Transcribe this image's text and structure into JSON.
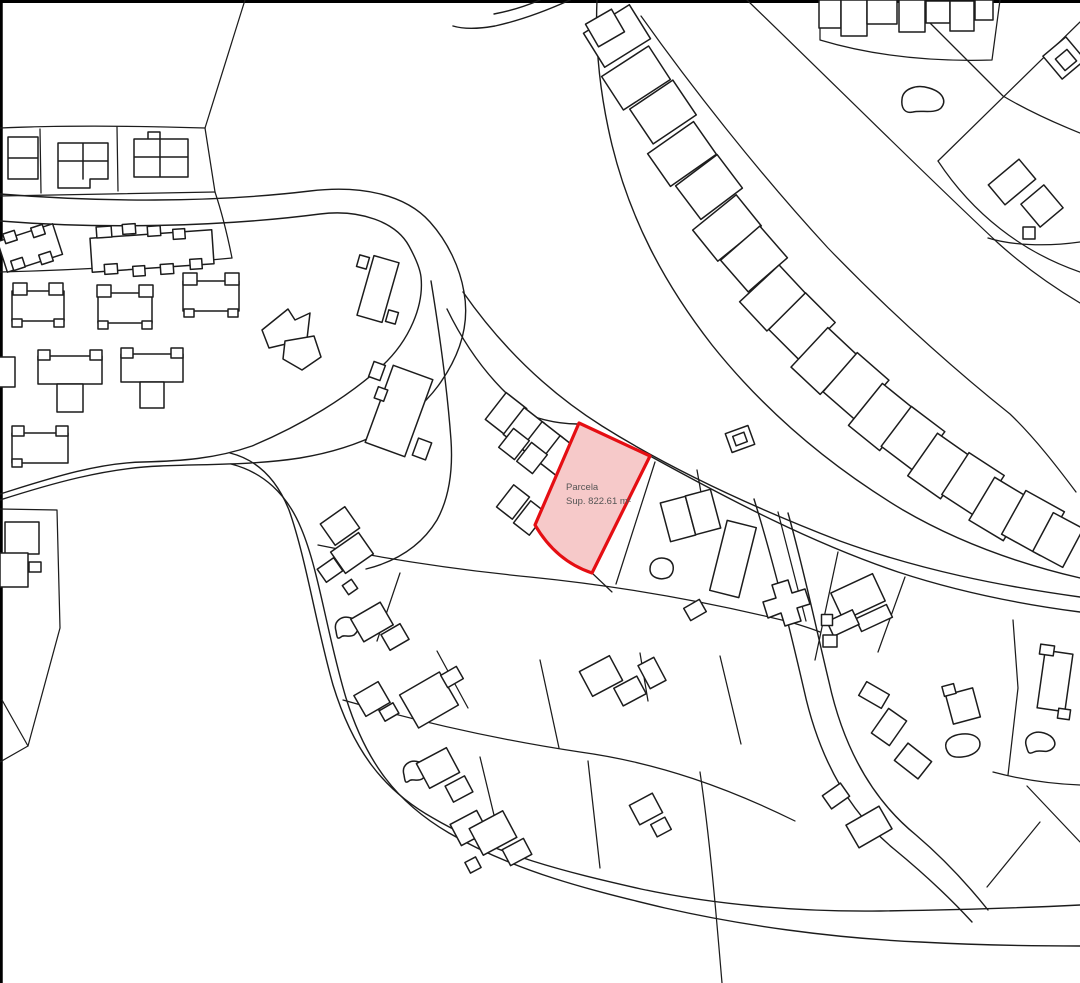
{
  "map": {
    "width": 1080,
    "height": 983,
    "background": "#ffffff",
    "line_color": "#1c1c1c",
    "border_color": "#000000",
    "highlight": {
      "label_line1": "Parcela",
      "label_line2": "Sup. 822.61 m²",
      "fill": "#f6c9c9",
      "stroke": "#e50e13",
      "text_color": "#555555"
    },
    "layers": [
      {
        "name": "frame",
        "interactable": false,
        "stroke": "#000000",
        "width": 3,
        "paths": [
          "M0,1.5 H1080",
          "M1.25,0 V983"
        ]
      },
      {
        "name": "roads",
        "interactable": false,
        "stroke": "#1c1c1c",
        "width": 1.4,
        "paths": [
          "M0,194 C100,202 210,203 310,191 C360,185 405,194 430,222 C448,242 460,268 464,292 C470,325 460,356 438,386 C410,424 360,448 300,458 C255,465 210,464 160,466 C105,468 50,484 0,500",
          "M0,221 C100,229 220,227 320,214 C360,209 396,222 409,246 C415,257 420,268 421,277 C424,305 410,340 382,366 C348,397 302,425 252,446 C215,459 180,461 143,462 C95,463 45,480 0,494",
          "M431,281 C439,330 447,385 451,440 C453,470 449,498 437,520 C420,548 394,562 366,569",
          "M447,309 C466,348 490,380 518,404",
          "M463,292 C500,345 545,390 602,426 C672,470 752,507 840,541 C920,570 1000,586 1080,597",
          "M506,406 C532,418 557,424 577,424",
          "M650,456 C730,500 812,543 898,572 C962,593 1026,605 1080,612",
          "M597,0 C595,45 600,95 612,145 C630,218 663,282 712,345 C768,415 833,468 903,510 C958,542 1020,564 1080,578",
          "M570,0 C548,10 522,20 495,26 C478,29 463,29 453,26",
          "M540,0 C526,6 510,11 494,14",
          "M231,464 C263,472 287,494 301,528 C319,570 327,635 346,698 C366,762 396,802 449,833 C516,872 590,890 665,908 C740,925 830,938 920,942 C975,945 1030,946 1080,946",
          "M230,453 C258,460 277,480 289,510 C306,558 316,625 333,685 C353,750 383,790 433,818 C496,855 566,872 641,889 C716,905 800,912 880,911 C950,910 1020,908 1080,905",
          "M754,499 C773,560 789,625 804,690 C819,758 849,812 894,849 C922,872 950,898 972,922",
          "M788,513 C804,570 816,628 829,682 C844,750 873,800 916,835 C943,858 968,885 988,910"
        ]
      },
      {
        "name": "parcel-lines",
        "interactable": false,
        "stroke": "#1c1c1c",
        "width": 1.25,
        "paths": [
          "M245,0 L205,128",
          "M0,128 C70,125 140,126 205,128",
          "M0,196 C75,195 145,193 215,192",
          "M205,128 L215,192",
          "M40,129 L41,193",
          "M117,127 L118,191",
          "M215,192 C223,216 228,238 232,258",
          "M0,272 C80,270 160,265 232,258",
          "M0,509 L57,510 L60,628 L28,746 L0,762",
          "M2,700 L28,746",
          "M641,16 C690,85 758,172 828,248 C888,310 950,366 1010,414 C1035,438 1058,468 1076,492",
          "M747,0 C830,80 918,168 998,243 C1028,270 1055,288 1080,303",
          "M920,13 L1003,96 C1030,112 1055,123 1080,133",
          "M1080,22 L938,161",
          "M938,161 C973,214 1022,252 1080,272",
          "M820,0 L820,40 C870,55 925,62 992,60 L1000,0",
          "M988,238 C1010,245 1045,247 1080,242",
          "M318,545 C390,560 460,570 530,577 C610,585 700,600 790,622 C800,625 810,628 820,632",
          "M343,700 C420,722 500,740 580,752 C660,763 730,789 795,821",
          "M655,462 L616,584",
          "M592,573 L612,592",
          "M697,470 L706,521",
          "M778,512 L806,621",
          "M838,552 L815,660",
          "M905,577 L878,652",
          "M400,573 L377,641",
          "M437,651 L468,708",
          "M540,660 L559,748",
          "M640,653 L648,701",
          "M720,656 L741,744",
          "M480,757 L500,840",
          "M588,761 L600,868",
          "M700,772 C710,840 716,912 722,983",
          "M1013,620 L1018,688 L1008,775",
          "M993,772 C1023,780 1052,784 1080,785",
          "M1027,786 L1080,842",
          "M1040,822 L987,887"
        ]
      },
      {
        "name": "building-footprints",
        "interactable": false,
        "stroke": "#1c1c1c",
        "width": 1.5,
        "fill": "#ffffff",
        "paths": [
          "M8,137 h30 v42 h-30 z M8,158 h30",
          "M58,143 h50 v36 h-18 v9 h-32 z M83,143 v36 M58,161 h50",
          "M134,139 h54 v38 h-54 z M160,139 v38 M134,157 h54 M148,132 h12 v7 h-12 z",
          "M262,330 l26,-21 7,11 15,-7 -3,26 -38,9 z",
          "M285,341 l29,-5 7,21 -19,13 -19,-11 z",
          "M902,99 C903,89 916,84 929,88 C943,92 947,101 941,108 C935,114 921,110 913,112 C904,114 901,107 902,99 Z",
          "M650,569 C650,560 659,556 667,559 C675,562 675,572 669,577 C661,581 650,578 650,569 Z",
          "M336,631 C333,621 342,615 351,618 C360,621 360,630 354,635 C349,638 344,634 341,637 C337,640 337,637 336,631 Z",
          "M404,775 C401,765 410,759 419,762 C428,765 428,775 422,779 C417,782 412,778 409,781 C405,784 405,781 404,775 Z",
          "M1026,745 C1024,736 1034,730 1044,733 C1054,736 1058,744 1052,749 C1046,754 1040,749 1034,752 C1028,755 1028,752 1026,745 Z",
          "M946,748 C944,740 952,735 962,734 C972,733 980,737 980,744 C980,751 972,756 962,757 C952,758 948,755 946,748 Z",
          "M772,585 l16,-5 4,13 13,-4 5,15 -13,4 4,13 -16,5 -4,-13 -13,5 -5,-16 13,-4 z"
        ]
      },
      {
        "name": "building-blocks",
        "interactable": false,
        "stroke": "#1c1c1c",
        "width": 1.5,
        "fill": "#ffffff",
        "rects": [
          [
            30,
            248,
            -18,
            58,
            32
          ],
          [
            10,
            237,
            -18,
            12,
            10
          ],
          [
            38,
            231,
            -18,
            12,
            10
          ],
          [
            18,
            264,
            -18,
            12,
            10
          ],
          [
            46,
            258,
            -18,
            12,
            10
          ],
          [
            152,
            251,
            -4,
            122,
            34
          ],
          [
            104,
            232,
            -4,
            15,
            11
          ],
          [
            129,
            229,
            -4,
            13,
            10
          ],
          [
            154,
            231,
            -4,
            13,
            10
          ],
          [
            179,
            234,
            -4,
            12,
            10
          ],
          [
            111,
            269,
            -4,
            13,
            10
          ],
          [
            139,
            271,
            -4,
            12,
            10
          ],
          [
            167,
            269,
            -4,
            13,
            10
          ],
          [
            196,
            264,
            -4,
            12,
            10
          ],
          [
            38,
            306,
            0,
            52,
            30
          ],
          [
            20,
            289,
            0,
            14,
            12
          ],
          [
            56,
            289,
            0,
            14,
            12
          ],
          [
            17,
            323,
            0,
            10,
            8
          ],
          [
            59,
            323,
            0,
            10,
            8
          ],
          [
            125,
            308,
            0,
            54,
            30
          ],
          [
            104,
            291,
            0,
            14,
            12
          ],
          [
            146,
            291,
            0,
            14,
            12
          ],
          [
            103,
            325,
            0,
            10,
            8
          ],
          [
            147,
            325,
            0,
            10,
            8
          ],
          [
            211,
            296,
            0,
            56,
            30
          ],
          [
            190,
            279,
            0,
            14,
            12
          ],
          [
            232,
            279,
            0,
            14,
            12
          ],
          [
            189,
            313,
            0,
            10,
            8
          ],
          [
            233,
            313,
            0,
            10,
            8
          ],
          [
            6,
            372,
            0,
            18,
            30
          ],
          [
            70,
            370,
            0,
            64,
            28
          ],
          [
            44,
            355,
            0,
            12,
            10
          ],
          [
            96,
            355,
            0,
            12,
            10
          ],
          [
            70,
            398,
            0,
            26,
            28
          ],
          [
            152,
            368,
            0,
            62,
            28
          ],
          [
            127,
            353,
            0,
            12,
            10
          ],
          [
            177,
            353,
            0,
            12,
            10
          ],
          [
            152,
            395,
            0,
            24,
            26
          ],
          [
            40,
            448,
            0,
            56,
            30
          ],
          [
            18,
            431,
            0,
            12,
            10
          ],
          [
            62,
            431,
            0,
            12,
            10
          ],
          [
            17,
            463,
            0,
            10,
            8
          ],
          [
            22,
            538,
            0,
            34,
            32
          ],
          [
            14,
            570,
            0,
            28,
            34
          ],
          [
            35,
            567,
            0,
            12,
            10
          ],
          [
            378,
            289,
            -74,
            62,
            26
          ],
          [
            363,
            262,
            -74,
            12,
            10
          ],
          [
            392,
            317,
            -74,
            12,
            10
          ],
          [
            399,
            411,
            -70,
            82,
            42
          ],
          [
            377,
            371,
            -70,
            16,
            12
          ],
          [
            422,
            449,
            -70,
            18,
            14
          ],
          [
            381,
            394,
            -70,
            12,
            10
          ],
          [
            506,
            414,
            38,
            26,
            34
          ],
          [
            524,
            429,
            38,
            26,
            34
          ],
          [
            542,
            443,
            38,
            26,
            34
          ],
          [
            560,
            457,
            38,
            26,
            34
          ],
          [
            514,
            444,
            38,
            20,
            24
          ],
          [
            532,
            458,
            38,
            20,
            24
          ],
          [
            513,
            502,
            38,
            20,
            28
          ],
          [
            530,
            518,
            38,
            20,
            28
          ],
          [
            617,
            36,
            58,
            40,
            54
          ],
          [
            636,
            78,
            57,
            40,
            56
          ],
          [
            663,
            112,
            56,
            42,
            52
          ],
          [
            682,
            154,
            55,
            40,
            56
          ],
          [
            709,
            187,
            53,
            42,
            52
          ],
          [
            727,
            228,
            51,
            40,
            56
          ],
          [
            754,
            259,
            49,
            42,
            52
          ],
          [
            773,
            298,
            47,
            40,
            54
          ],
          [
            802,
            326,
            45,
            42,
            52
          ],
          [
            824,
            361,
            43,
            40,
            54
          ],
          [
            856,
            386,
            41,
            42,
            52
          ],
          [
            881,
            417,
            39,
            40,
            54
          ],
          [
            913,
            439,
            37,
            42,
            50
          ],
          [
            939,
            466,
            35,
            40,
            52
          ],
          [
            973,
            485,
            33,
            42,
            50
          ],
          [
            999,
            509,
            31,
            40,
            50
          ],
          [
            1033,
            523,
            29,
            44,
            50
          ],
          [
            605,
            28,
            60,
            26,
            30
          ],
          [
            1058,
            540,
            28,
            34,
            44
          ],
          [
            830,
            14,
            0,
            22,
            28
          ],
          [
            854,
            18,
            0,
            26,
            36
          ],
          [
            882,
            12,
            0,
            30,
            24
          ],
          [
            912,
            16,
            0,
            26,
            32
          ],
          [
            938,
            12,
            0,
            24,
            22
          ],
          [
            962,
            16,
            0,
            24,
            30
          ],
          [
            984,
            10,
            0,
            18,
            20
          ],
          [
            1064,
            58,
            -40,
            30,
            30
          ],
          [
            1066,
            60,
            -40,
            15,
            15
          ],
          [
            1012,
            182,
            -40,
            40,
            26
          ],
          [
            1042,
            206,
            -40,
            30,
            30
          ],
          [
            1029,
            233,
            0,
            12,
            12
          ],
          [
            740,
            439,
            -20,
            24,
            20
          ],
          [
            740,
            439,
            -20,
            12,
            10
          ],
          [
            678,
            519,
            -15,
            26,
            40
          ],
          [
            703,
            512,
            -15,
            26,
            40
          ],
          [
            733,
            559,
            14,
            30,
            72
          ],
          [
            858,
            597,
            -25,
            46,
            30
          ],
          [
            874,
            618,
            -25,
            34,
            14
          ],
          [
            843,
            623,
            -25,
            28,
            16
          ],
          [
            830,
            641,
            0,
            14,
            12
          ],
          [
            827,
            620,
            0,
            11,
            11
          ],
          [
            1055,
            681,
            8,
            28,
            58
          ],
          [
            1047,
            650,
            8,
            14,
            10
          ],
          [
            1064,
            714,
            8,
            12,
            10
          ],
          [
            963,
            706,
            -15,
            28,
            30
          ],
          [
            949,
            690,
            -15,
            12,
            10
          ],
          [
            874,
            695,
            30,
            26,
            16
          ],
          [
            889,
            727,
            35,
            22,
            30
          ],
          [
            913,
            761,
            38,
            30,
            22
          ],
          [
            836,
            796,
            -35,
            22,
            16
          ],
          [
            869,
            827,
            -30,
            38,
            26
          ],
          [
            340,
            526,
            -35,
            30,
            26
          ],
          [
            352,
            553,
            -35,
            34,
            26
          ],
          [
            330,
            570,
            -35,
            20,
            16
          ],
          [
            350,
            587,
            -35,
            11,
            11
          ],
          [
            372,
            622,
            -30,
            34,
            26
          ],
          [
            395,
            637,
            -30,
            22,
            18
          ],
          [
            372,
            699,
            -30,
            28,
            24
          ],
          [
            389,
            712,
            -30,
            16,
            12
          ],
          [
            429,
            700,
            -30,
            46,
            38
          ],
          [
            452,
            677,
            -30,
            18,
            14
          ],
          [
            438,
            768,
            -28,
            34,
            28
          ],
          [
            459,
            789,
            -28,
            22,
            18
          ],
          [
            469,
            828,
            -28,
            30,
            24
          ],
          [
            487,
            845,
            -28,
            16,
            12
          ],
          [
            493,
            833,
            -28,
            38,
            30
          ],
          [
            517,
            852,
            -28,
            24,
            18
          ],
          [
            473,
            865,
            -28,
            12,
            12
          ],
          [
            601,
            676,
            -28,
            34,
            28
          ],
          [
            630,
            691,
            -28,
            26,
            20
          ],
          [
            652,
            673,
            -28,
            18,
            26
          ],
          [
            646,
            809,
            -28,
            26,
            22
          ],
          [
            661,
            827,
            -28,
            16,
            14
          ],
          [
            695,
            610,
            -30,
            18,
            14
          ]
        ]
      },
      {
        "name": "highlighted-parcel",
        "interactable": true,
        "stroke": "#e50e13",
        "width": 3.2,
        "fill": "#f6c9c9",
        "paths": [
          "M579,423 L650,456 L592,573 Q556,561 535,525 Z"
        ]
      }
    ]
  }
}
